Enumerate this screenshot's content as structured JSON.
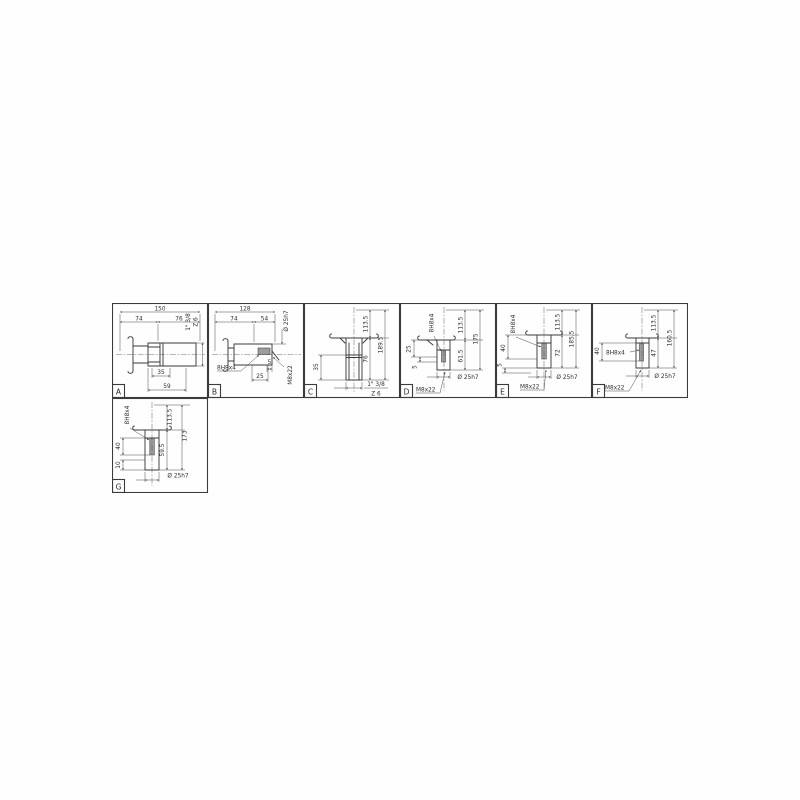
{
  "sheet": {
    "line_color": "#3b3b3b",
    "background": "#fefefe"
  },
  "panels": {
    "a": {
      "label": "A",
      "dims": {
        "total": "150",
        "left": "74",
        "right": "76",
        "spline": "1\" 3/8",
        "teeth": "Z 6",
        "hub": "35",
        "end": "59"
      }
    },
    "b": {
      "label": "B",
      "dims": {
        "total": "128",
        "left": "74",
        "right": "54",
        "bore": "Ø 25h7",
        "key": "8H8x4",
        "d5": "5",
        "d25": "25",
        "thread": "M8x22"
      }
    },
    "c": {
      "label": "C",
      "dims": {
        "drop": "113.5",
        "shaft": "76",
        "total": "189.5",
        "spline_len": "35",
        "spline": "1\" 3/8",
        "teeth": "Z 6"
      }
    },
    "d": {
      "label": "D",
      "dims": {
        "key": "8H8x4",
        "d25": "25",
        "d5": "5",
        "drop": "113.5",
        "shaft": "61.5",
        "total": "175",
        "thread": "M8x22",
        "bore": "Ø 25h7"
      }
    },
    "e": {
      "label": "E",
      "dims": {
        "key": "8H8x4",
        "d40": "40",
        "d5": "5",
        "drop": "113.5",
        "shaft": "72",
        "total": "185.5",
        "thread": "M8x22",
        "bore": "Ø 25h7"
      }
    },
    "f": {
      "label": "F",
      "dims": {
        "key": "8H8x4",
        "d40": "40",
        "drop": "113.5",
        "shaft": "47",
        "total": "160.5",
        "thread": "M8x22",
        "bore": "Ø 25h7"
      }
    },
    "g": {
      "label": "G",
      "dims": {
        "key": "8H8x4",
        "d40": "40",
        "d10": "10",
        "drop": "113.5",
        "shaft": "59.5",
        "total": "173",
        "bore": "Ø 25h7"
      }
    }
  }
}
